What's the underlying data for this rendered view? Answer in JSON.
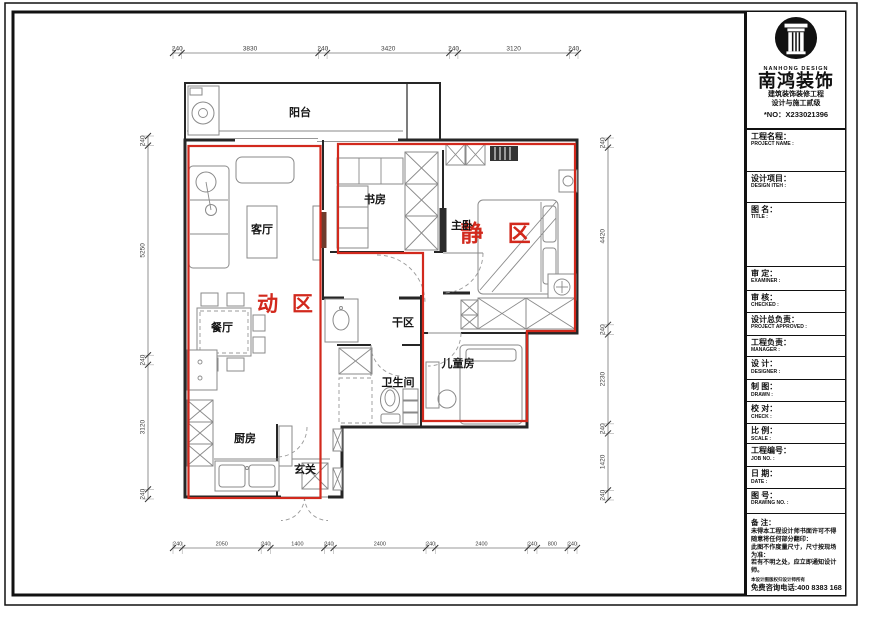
{
  "logo": {
    "en": "NANHONG DESIGN",
    "cn": "南鸿装饰",
    "cert1": "建筑装饰装修工程",
    "cert2": "设计与施工贰级",
    "no": "*NO：X233021396"
  },
  "titleblock": {
    "rows": [
      {
        "cn": "工程名程：",
        "en": "PROJECT NAME :"
      },
      {
        "cn": "设计项目：",
        "en": "DESIGN ITEH :"
      },
      {
        "cn": "图 名：",
        "en": "TITLE :"
      },
      {
        "cn": "审 定：",
        "en": "EXAMINER :"
      },
      {
        "cn": "审 核：",
        "en": "CHECKED :"
      },
      {
        "cn": "设计总负责：",
        "en": "PROJECT APPROVED :"
      },
      {
        "cn": "工程负责：",
        "en": "MANAGER :"
      },
      {
        "cn": "设 计：",
        "en": "DESIGNER :"
      },
      {
        "cn": "制 图：",
        "en": "DRAWN :"
      },
      {
        "cn": "校 对：",
        "en": "CHECK :"
      },
      {
        "cn": "比 例：",
        "en": "SCALE :"
      },
      {
        "cn": "工程编号：",
        "en": "JOB NO. :"
      },
      {
        "cn": "日 期：",
        "en": "DATE :"
      },
      {
        "cn": "图 号：",
        "en": "DRAWING NO. :"
      }
    ],
    "remarks": {
      "title": "备 注：",
      "body": "未得本工程设计师书面许可不得\n随意将任何部分翻印：\n此图不作度量尺寸，尺寸按现场\n为准：\n若有不明之处，应立即通知设计\n师。",
      "small": "本设计图版权归设计师所有",
      "phone": "免费咨询电话:400 8383 168"
    }
  },
  "plan": {
    "rooms": {
      "balcony": "阳台",
      "living": "客厅",
      "dining": "餐厅",
      "kitchen": "厨房",
      "entry": "玄关",
      "dry": "干区",
      "bath": "卫生间",
      "study": "书房",
      "master": "主卧",
      "kids": "儿童房"
    },
    "zones": {
      "active": "动 区",
      "quiet": "静 区"
    },
    "dims": {
      "top": [
        "240",
        "3830",
        "240",
        "3420",
        "240",
        "3120",
        "240"
      ],
      "left": [
        "240",
        "5250",
        "240",
        "3120",
        "240"
      ],
      "right": [
        "240",
        "4420",
        "240",
        "2230",
        "240",
        "1420",
        "240"
      ],
      "bottom": [
        "240",
        "2050",
        "240",
        "1400",
        "240",
        "2400",
        "240",
        "2400",
        "240",
        "800",
        "240"
      ]
    },
    "colors": {
      "zone": "#d2291d",
      "wall": "#262626"
    }
  }
}
